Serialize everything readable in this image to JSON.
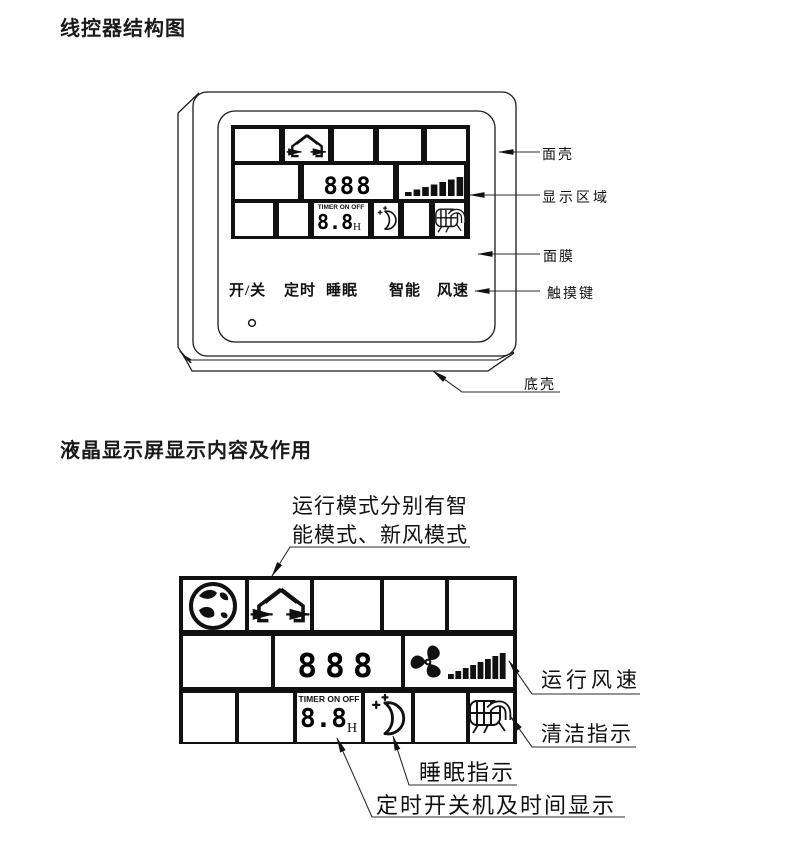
{
  "colors": {
    "ink": "#111111",
    "leader": "#2b2b2b",
    "bg": "#ffffff"
  },
  "titles": {
    "section1": "线控器结构图",
    "section2": "液晶显示屏显示内容及作用"
  },
  "controller_diagram": {
    "callouts": {
      "front_shell": "面壳",
      "display_area": "显示区域",
      "membrane": "面膜",
      "touch_keys": "触摸键",
      "bottom_shell": "底壳"
    },
    "buttons": [
      {
        "label": "开/关"
      },
      {
        "label": "定时"
      },
      {
        "label": "睡眠"
      },
      {
        "label": "智能"
      },
      {
        "label": "风速"
      }
    ],
    "lcd": {
      "mode_digits": "888",
      "timer_caption": "TIMER ON OFF",
      "timer_digits": "8.8",
      "timer_unit": "H"
    }
  },
  "lcd_diagram": {
    "annotation_mode_line1": "运行模式分别有智",
    "annotation_mode_line2": "能模式、新风模式",
    "callouts": {
      "fan_speed": "运行风速",
      "clean_indicator": "清洁指示",
      "sleep_indicator": "睡眠指示",
      "timer_display": "定时开关机及时间显示"
    },
    "lcd": {
      "mode_digits": "888",
      "timer_caption": "TIMER ON OFF",
      "timer_digits": "8.8",
      "timer_unit": "H"
    }
  },
  "icons": {
    "fresh_air_mode": "house-with-airflow-arrows",
    "smart_mode": "globe",
    "sleep": "crescent-moon-with-stars",
    "clean_reminder": "filter-with-duct",
    "fan": "fan-blades",
    "fan_speed": "rising-bar-triangle",
    "power_dot": "small-circle"
  }
}
